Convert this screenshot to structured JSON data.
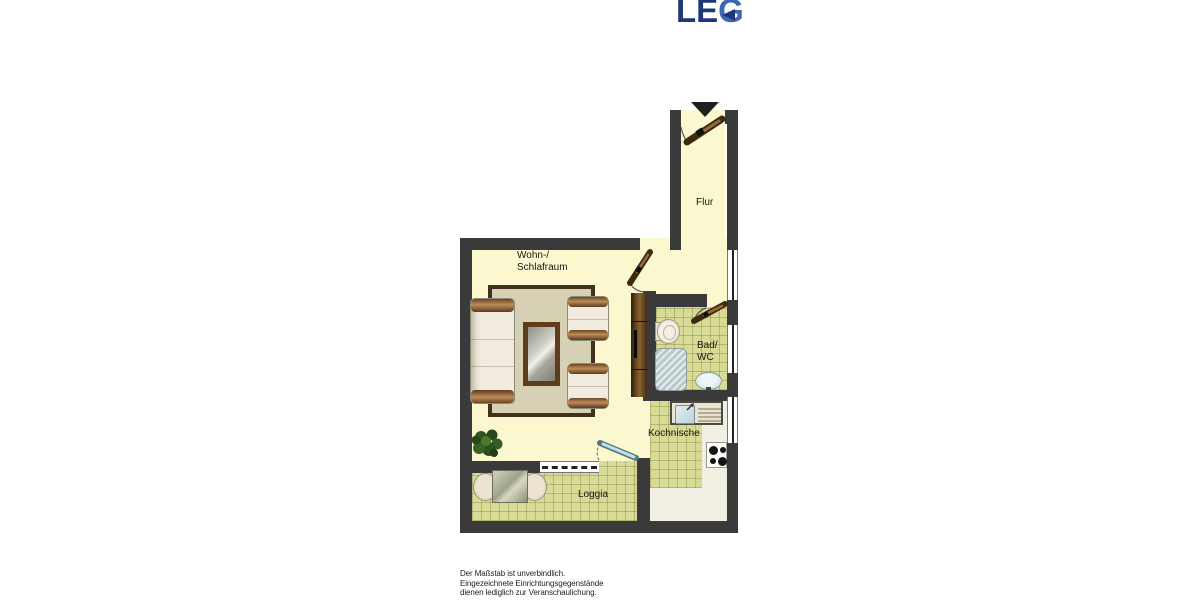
{
  "logo": {
    "le": "LE",
    "g": "G",
    "color_primary": "#1e3876",
    "color_accent": "#3d69b1"
  },
  "plan": {
    "rooms": {
      "flur": {
        "label": "Flur"
      },
      "living": {
        "label": "Wohn-/\nSchlafraum"
      },
      "bath": {
        "label": "Bad/\nWC"
      },
      "kitchen": {
        "label": "Kochnische"
      },
      "loggia": {
        "label": "Loggia"
      }
    },
    "icons": {
      "entrance_arrow": "▼"
    },
    "colors": {
      "wall": "#3a3a3a",
      "floor": "#fbf8d0",
      "tile": "#d8db95",
      "door_wood": "#3f2a10",
      "glass_door": "#bce2ea"
    }
  },
  "footer": {
    "disclaimer": "Der Maßstab ist unverbindlich.\nEingezeichnete Einrichtungsgegenstände\ndienen lediglich zur Veranschaulichung."
  }
}
